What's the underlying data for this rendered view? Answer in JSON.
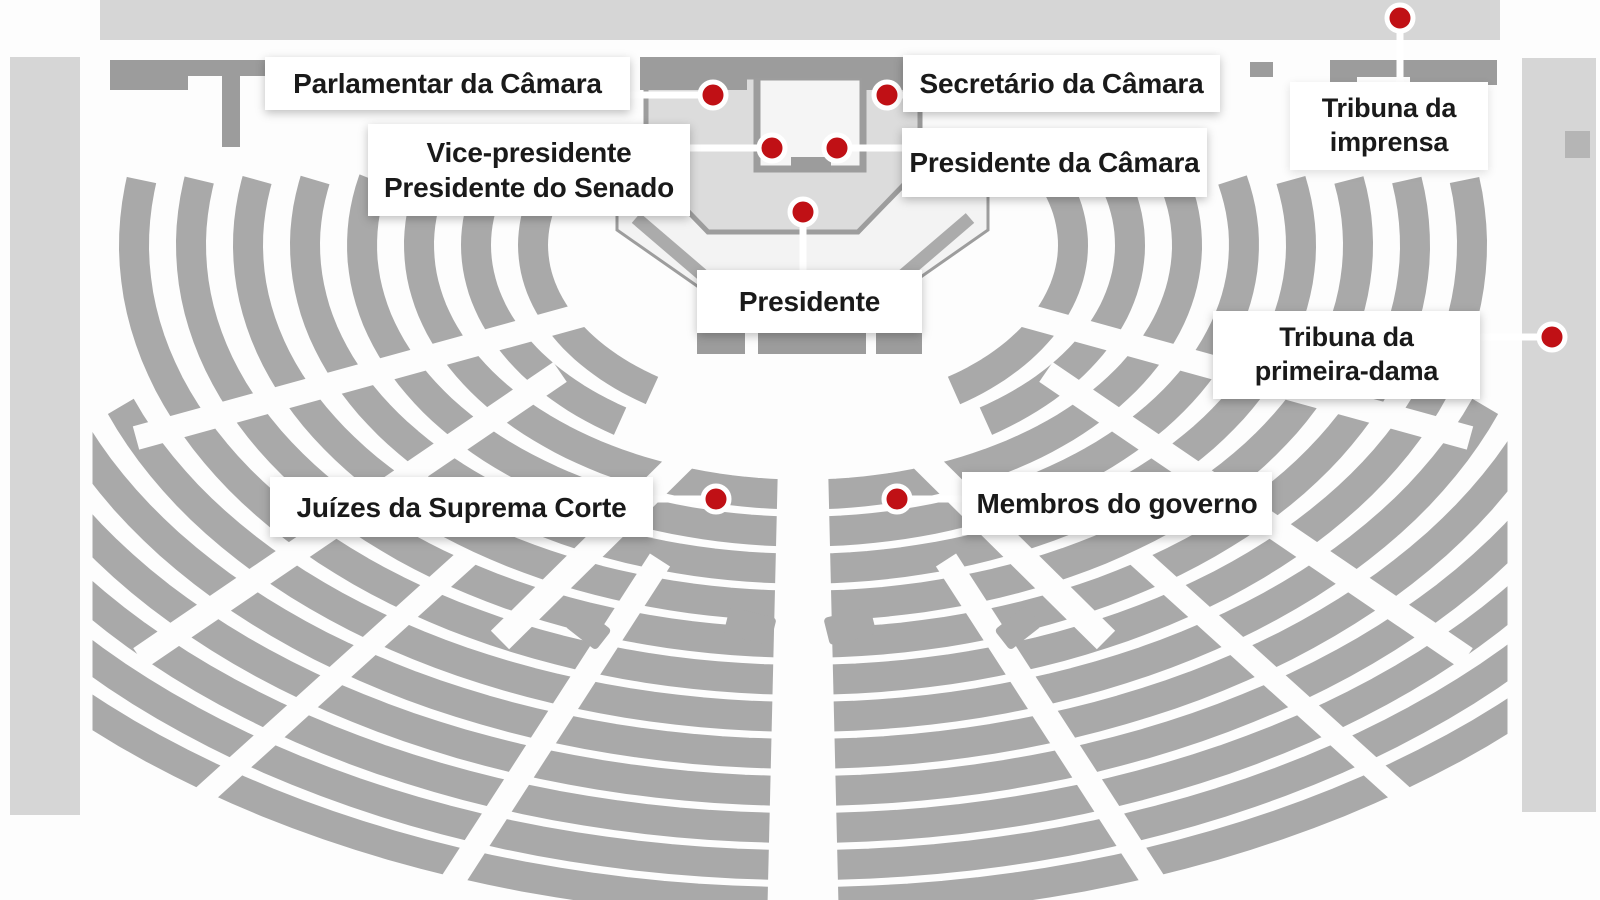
{
  "diagram_title": "Plenário - mapa de assentos",
  "colors": {
    "accent_red": "#c01015",
    "seat_gray": "#a9a9a9",
    "band_gray": "#d6d6d6",
    "structure_gray": "#9c9c9c",
    "mesa_fill": "#dcdcdc",
    "platform_fill": "#f3f3f3",
    "well_fill": "#f5f5f5",
    "outline_gray": "#9d9d9d",
    "ramp_gray": "#ababab",
    "leader_white": "#ffffff",
    "label_bg": "#ffffff",
    "label_text": "#1a1a1a"
  },
  "labels": {
    "parlamentar": {
      "text": "Parlamentar da Câmara"
    },
    "secretario": {
      "text": "Secretário da Câmara"
    },
    "vice": {
      "line1": "Vice-presidente",
      "line2": "Presidente do Senado"
    },
    "pres_camara": {
      "text": "Presidente da Câmara"
    },
    "tribuna_imprensa": {
      "line1": "Tribuna da",
      "line2": "imprensa"
    },
    "presidente": {
      "text": "Presidente"
    },
    "tribuna_dama": {
      "line1": "Tribuna da",
      "line2": "primeira-dama"
    },
    "juizes": {
      "text": "Juízes da Suprema Corte"
    },
    "membros": {
      "text": "Membros do governo"
    }
  },
  "seats": [
    {
      "id": "parlamentar",
      "label": "Parlamentar da Câmara"
    },
    {
      "id": "secretario",
      "label": "Secretário da Câmara"
    },
    {
      "id": "vice",
      "label": "Vice-presidente / Presidente do Senado"
    },
    {
      "id": "pres-camara",
      "label": "Presidente da Câmara"
    },
    {
      "id": "presidente",
      "label": "Presidente"
    },
    {
      "id": "imprensa",
      "label": "Tribuna da imprensa"
    },
    {
      "id": "primeira-dama",
      "label": "Tribuna da primeira-dama"
    },
    {
      "id": "juizes",
      "label": "Juízes da Suprema Corte"
    },
    {
      "id": "membros",
      "label": "Membros do governo"
    }
  ]
}
